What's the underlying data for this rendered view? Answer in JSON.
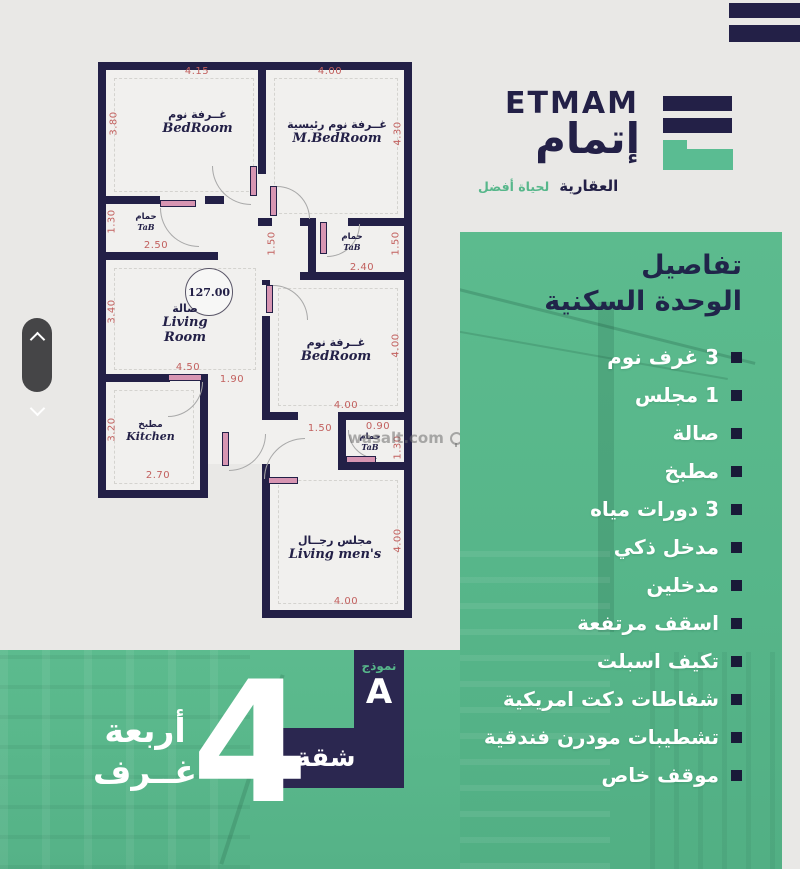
{
  "colors": {
    "background": "#e9e8e6",
    "green": "#57b78b",
    "navy": "#232047",
    "banner_navy": "#2b2750",
    "dimension_red": "#c2605e",
    "white": "#ffffff"
  },
  "logo": {
    "brand_en": "ETMAM",
    "brand_ar": "إتمام",
    "division": "العقارية",
    "tagline": "لحياة أفضل"
  },
  "panel": {
    "title_line1": "تفاصيل",
    "title_line2": "الوحدة السكنية",
    "items": [
      "3 غرف نوم",
      "1 مجلس",
      "صالة",
      "مطبخ",
      "3 دورات مياه",
      "مدخل ذكي",
      "مدخلين",
      "اسقف مرتفعة",
      "تكيف اسبلت",
      "شفاطات دكت امريكية",
      "تشطيبات مودرن فندقية",
      "موقف خاص"
    ]
  },
  "banner": {
    "model_label": "نموذج",
    "model_value": "A",
    "unit_label": "شقة",
    "big_number": "4",
    "line1": "أربعة",
    "line2": "غــرف"
  },
  "floorplan": {
    "watermark": "wasalt.com",
    "area_circle": "127.00",
    "rooms": [
      {
        "ar": "غــرفة نوم",
        "en": "BedRoom"
      },
      {
        "ar": "غــرفة نوم رئيسية",
        "en": "M.BedRoom"
      },
      {
        "ar": "حمام",
        "en": "TaB"
      },
      {
        "ar": "حمام",
        "en": "TaB"
      },
      {
        "ar": "صالة",
        "en": "Living Room"
      },
      {
        "ar": "غــرفة نوم",
        "en": "BedRoom"
      },
      {
        "ar": "مطبخ",
        "en": "Kitchen"
      },
      {
        "ar": "حمام",
        "en": "TaB"
      },
      {
        "ar": "مجلس رجــال",
        "en": "Living men's"
      }
    ],
    "dims": [
      "4.15",
      "4.00",
      "3.80",
      "4.30",
      "1.30",
      "2.50",
      "1.50",
      "1.50",
      "2.40",
      "3.40",
      "4.50",
      "1.90",
      "3.20",
      "2.70",
      "4.00",
      "4.00",
      "1.50",
      "0.90",
      "1.30",
      "4.00",
      "4.00"
    ]
  }
}
